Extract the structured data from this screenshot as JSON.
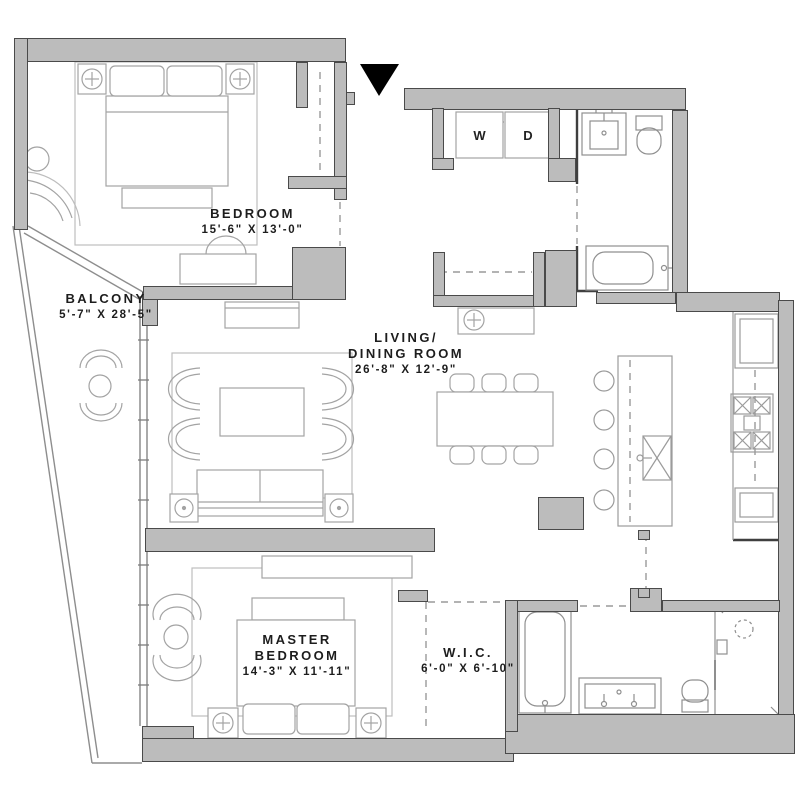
{
  "floorplan": {
    "rooms": {
      "bedroom": {
        "name": "BEDROOM",
        "dims": "15'-6\" X 13'-0\""
      },
      "balcony": {
        "name": "BALCONY",
        "dims": "5'-7\" X 28'-5\""
      },
      "living": {
        "name_line1": "LIVING/",
        "name_line2": "DINING ROOM",
        "dims": "26'-8\" X 12'-9\""
      },
      "master": {
        "name_line1": "MASTER",
        "name_line2": "BEDROOM",
        "dims": "14'-3\" X 11'-11\""
      },
      "wic": {
        "name": "W.I.C.",
        "dims": "6'-0\" X 6'-10\""
      }
    },
    "laundry": {
      "washer": "W",
      "dryer": "D"
    },
    "colors": {
      "wall_fill": "#bcbcbc",
      "wall_outline": "#4a4a4a",
      "furniture_line": "#a3a3a3",
      "fixture_line": "#8f8f8f",
      "text": "#1d1d1d",
      "entry_marker": "#000000",
      "background": "#ffffff"
    }
  }
}
